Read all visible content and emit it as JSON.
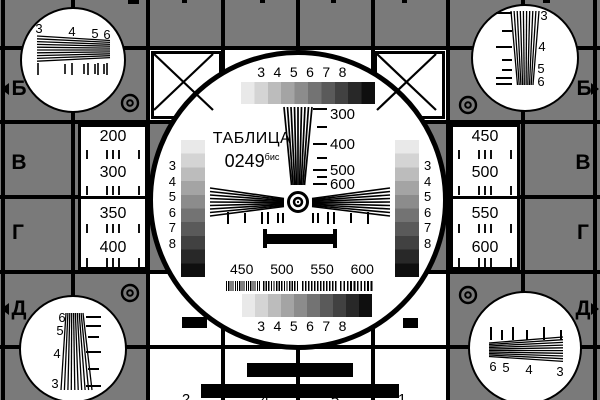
{
  "card": {
    "title": "ТАБЛИЦА",
    "number": "0249",
    "number_suffix": "бис",
    "row_letters_left": [
      "Б",
      "В",
      "Г",
      "Д"
    ],
    "row_letters_right": [
      "Б",
      "В",
      "Г",
      "Д"
    ],
    "left_cell_numbers": [
      "200",
      "300",
      "350",
      "400"
    ],
    "right_cell_numbers": [
      "450",
      "500",
      "550",
      "600"
    ],
    "center": {
      "top_gray_scale_labels": "3 4 5 6 7 8",
      "bottom_gray_scale_labels": "3 4 5 6 7 8",
      "vertical_wedge_labels": [
        "300",
        "400",
        "500",
        "600"
      ],
      "burst_labels": [
        "450",
        "500",
        "550",
        "600"
      ],
      "left_gray_column_digits": [
        "3",
        "4",
        "5",
        "6",
        "7",
        "8"
      ],
      "right_gray_column_digits": [
        "3",
        "4",
        "5",
        "6",
        "7",
        "8"
      ]
    },
    "corner_wedges": {
      "top_left_labels": [
        "3",
        "4",
        "5",
        "6"
      ],
      "top_right_labels": [
        "3",
        "4",
        "5",
        "6"
      ],
      "bottom_left_labels": [
        "6",
        "5",
        "4",
        "3"
      ],
      "bottom_right_labels": [
        "6",
        "5",
        "4",
        "3"
      ]
    },
    "bottom_edge_cut_labels": [
      "2",
      "4",
      "5",
      "1"
    ],
    "colors": {
      "background_gray": "#7a7a7a",
      "line_black": "#000000",
      "white": "#ffffff"
    }
  }
}
